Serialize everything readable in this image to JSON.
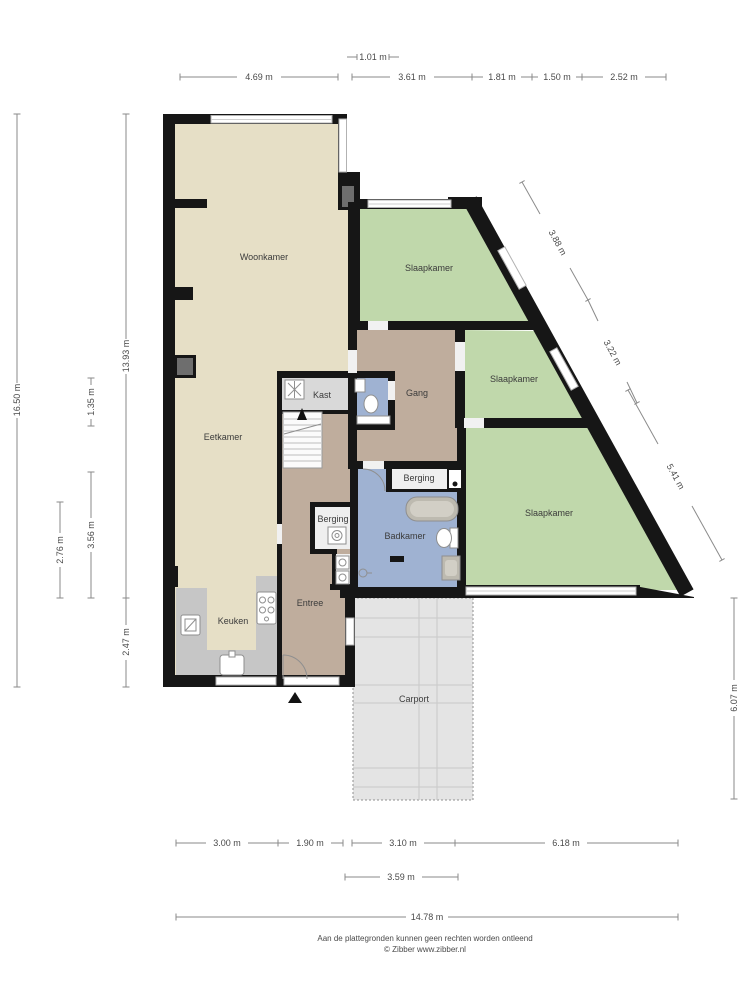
{
  "rooms": {
    "woonkamer": "Woonkamer",
    "slaapkamer_top": "Slaapkamer",
    "slaapkamer_mid": "Slaapkamer",
    "slaapkamer_bottom": "Slaapkamer",
    "eetkamer": "Eetkamer",
    "kast": "Kast",
    "gang": "Gang",
    "berging_gang": "Berging",
    "berging_hal": "Berging",
    "badkamer": "Badkamer",
    "keuken": "Keuken",
    "entree": "Entree",
    "carport": "Carport"
  },
  "dims": {
    "top": {
      "offset": "1.01 m",
      "a": "4.69 m",
      "b": "3.61 m",
      "c": "1.81 m",
      "d": "1.50 m",
      "e": "2.52 m"
    },
    "left": {
      "total": "16.50 m",
      "main": "13.93 m",
      "upper": "1.35 m",
      "mid": "3.56 m",
      "inner": "2.76 m",
      "lower": "2.47 m"
    },
    "right": {
      "a": "3.88 m",
      "b": "3.22 m",
      "c": "5.41 m",
      "d": "6.07 m"
    },
    "bottom": {
      "a": "3.00 m",
      "b": "1.90 m",
      "c": "3.10 m",
      "d": "6.18 m",
      "carport": "3.59 m",
      "total": "14.78 m"
    }
  },
  "footer": {
    "disclaimer": "Aan de plattegronden kunnen geen rechten worden ontleend",
    "credit": "© Zibber www.zibber.nl"
  },
  "colors": {
    "wall": "#161616",
    "bedroom": "#c0d8ab",
    "living": "#e6dfc6",
    "hall": "#bfad9d",
    "bath": "#9fb2d2",
    "closet": "#d9d9d9",
    "storage": "#efefef",
    "counter": "#c6c6c6",
    "carport": "#e4e4e4",
    "dim_line": "#8a8a8a",
    "label_text": "#3b3b3b"
  }
}
